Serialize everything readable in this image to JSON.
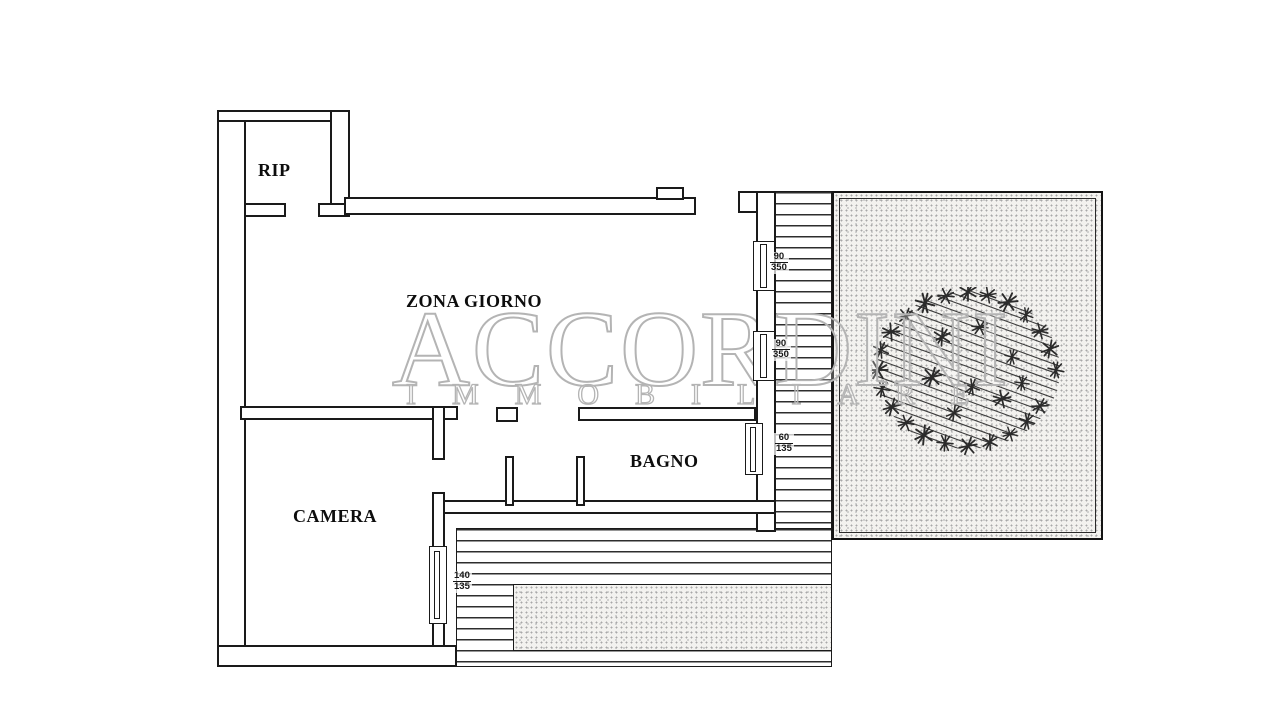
{
  "plan": {
    "rooms": [
      {
        "id": "rip",
        "label": "RIP"
      },
      {
        "id": "zona-giorno",
        "label": "ZONA GIORNO"
      },
      {
        "id": "bagno",
        "label": "BAGNO"
      },
      {
        "id": "camera",
        "label": "CAMERA"
      }
    ],
    "window_dimensions": [
      {
        "id": "living-window-1",
        "width": "90",
        "height": "350"
      },
      {
        "id": "living-window-2",
        "width": "90",
        "height": "350"
      },
      {
        "id": "bathroom-window",
        "width": "60",
        "height": "135"
      },
      {
        "id": "bedroom-window",
        "width": "140",
        "height": "135"
      }
    ]
  },
  "watermark": {
    "brand": "ACCORDINI",
    "subtitle": "IMMOBILIARE"
  },
  "colors": {
    "line": "#1a1a1a",
    "watermark_outline": "#b4b4b4",
    "stipple_dot": "#a8a8a8",
    "paper": "#ffffff"
  }
}
